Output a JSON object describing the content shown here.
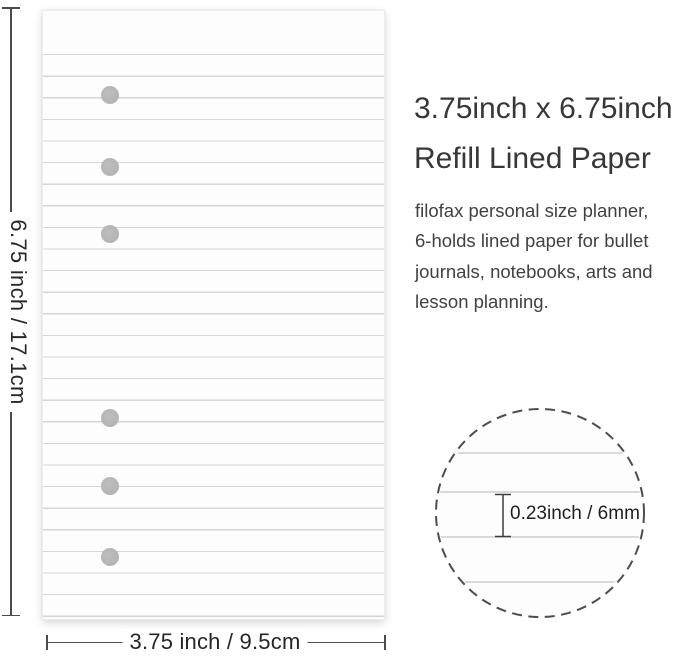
{
  "title": {
    "line1": "3.75inch x 6.75inch",
    "line2": "Refill Lined Paper"
  },
  "description": "filofax personal size planner,\n6-holds lined paper for bullet\njournals, notebooks, arts and\nlesson planning.",
  "dimension_labels": {
    "height": "6.75 inch / 17.1cm",
    "width": "3.75 inch / 9.5cm",
    "line_spacing": "0.23inch / 6mm"
  },
  "paper": {
    "hole_count": 6,
    "type": "lined refill paper"
  },
  "colors": {
    "paper_background": "#fdfdfd",
    "ruled_line": "#d5d5d5",
    "binder_hole": "#b7b7b7",
    "dimension_line": "#4c4c4c",
    "title_text": "#373737",
    "body_text": "#414141",
    "detail_circle_border": "#4d4d4d"
  }
}
